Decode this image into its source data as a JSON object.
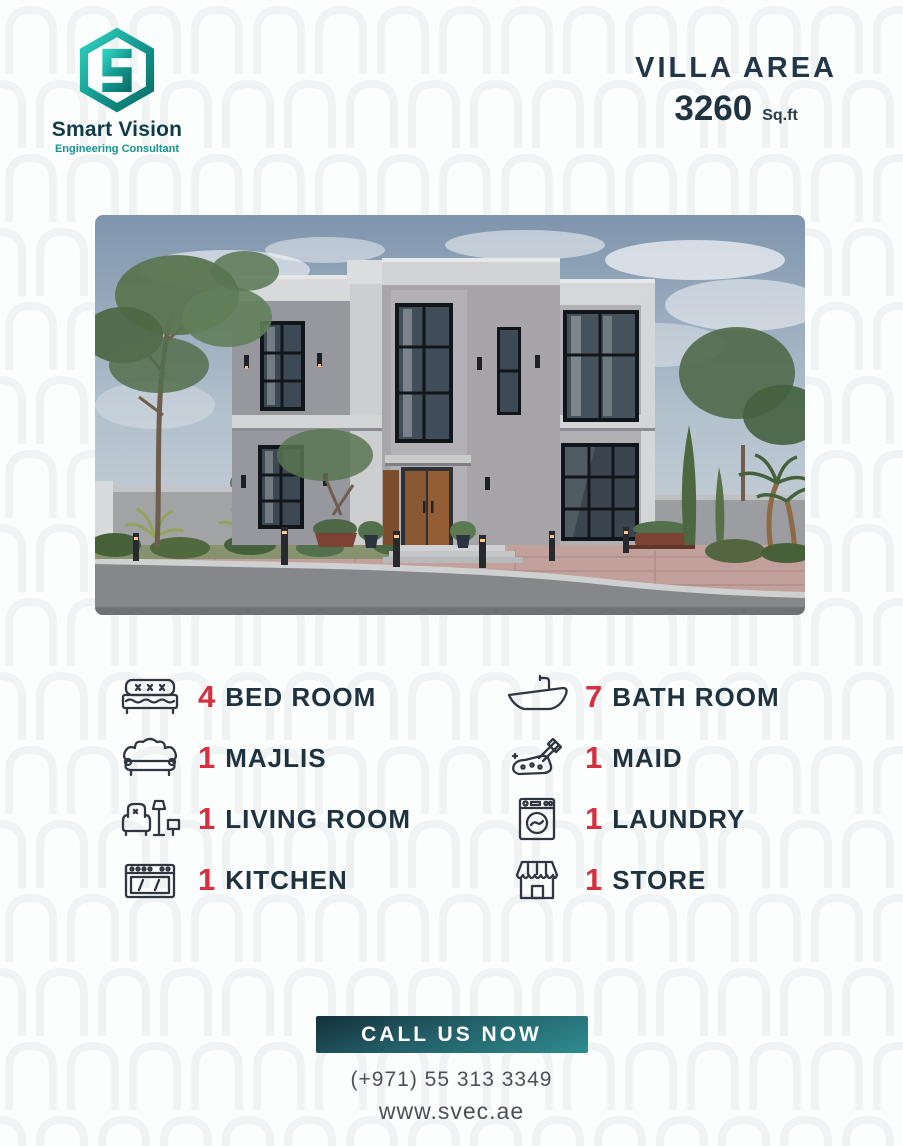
{
  "brand": {
    "name": "Smart Vision",
    "tagline": "Engineering Consultant"
  },
  "villa_area": {
    "label": "VILLA AREA",
    "value": "3260",
    "unit": "Sq.ft"
  },
  "features": {
    "left": [
      {
        "count": "4",
        "label": "BED ROOM",
        "icon": "bed-icon"
      },
      {
        "count": "1",
        "label": "MAJLIS",
        "icon": "sofa-icon"
      },
      {
        "count": "1",
        "label": "LIVING ROOM",
        "icon": "armchair-icon"
      },
      {
        "count": "1",
        "label": "KITCHEN",
        "icon": "stove-icon"
      }
    ],
    "right": [
      {
        "count": "7",
        "label": "BATH ROOM",
        "icon": "bathtub-icon"
      },
      {
        "count": "1",
        "label": "MAID",
        "icon": "cleaning-icon"
      },
      {
        "count": "1",
        "label": "LAUNDRY",
        "icon": "washing-machine-icon"
      },
      {
        "count": "1",
        "label": "STORE",
        "icon": "storefront-icon"
      }
    ]
  },
  "cta": {
    "button_label": "CALL US NOW",
    "phone": "(+971) 55 313 3349",
    "website": "www.svec.ae"
  },
  "colors": {
    "navy": "#1e3240",
    "red": "#d4303f",
    "teal": "#16948f",
    "teal_dark": "#142f3a",
    "text_gray": "#4c5156"
  }
}
